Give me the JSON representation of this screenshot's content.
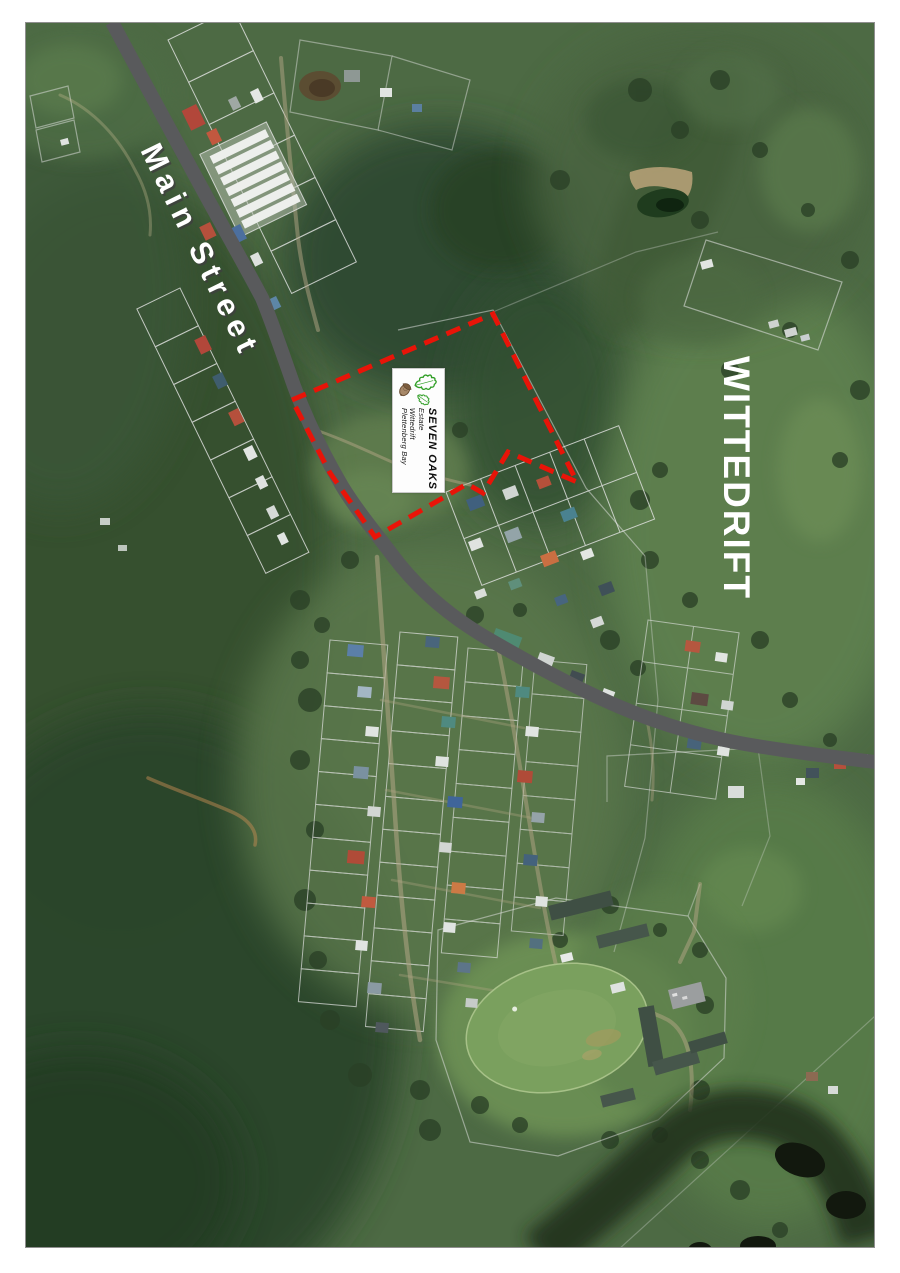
{
  "map": {
    "labels": {
      "street": "Main Street",
      "region": "WITTEDRIFT"
    },
    "estate_label": {
      "name": "SEVEN OAKS",
      "line2": "Estate",
      "line3": "Wittedrift",
      "line4": "Plettenberg Bay"
    },
    "boundary": {
      "points": "292,400 493,314 577,482 508,452 483,493 467,484 375,537 330,473"
    },
    "colors": {
      "boundary": "#e81408",
      "road": "#595a5c",
      "parcel_line": "#e6e6e6",
      "label_text": "#ffffff",
      "logo_leaf": "#2f9e25",
      "logo_acorn": "#8a6a4e"
    }
  }
}
